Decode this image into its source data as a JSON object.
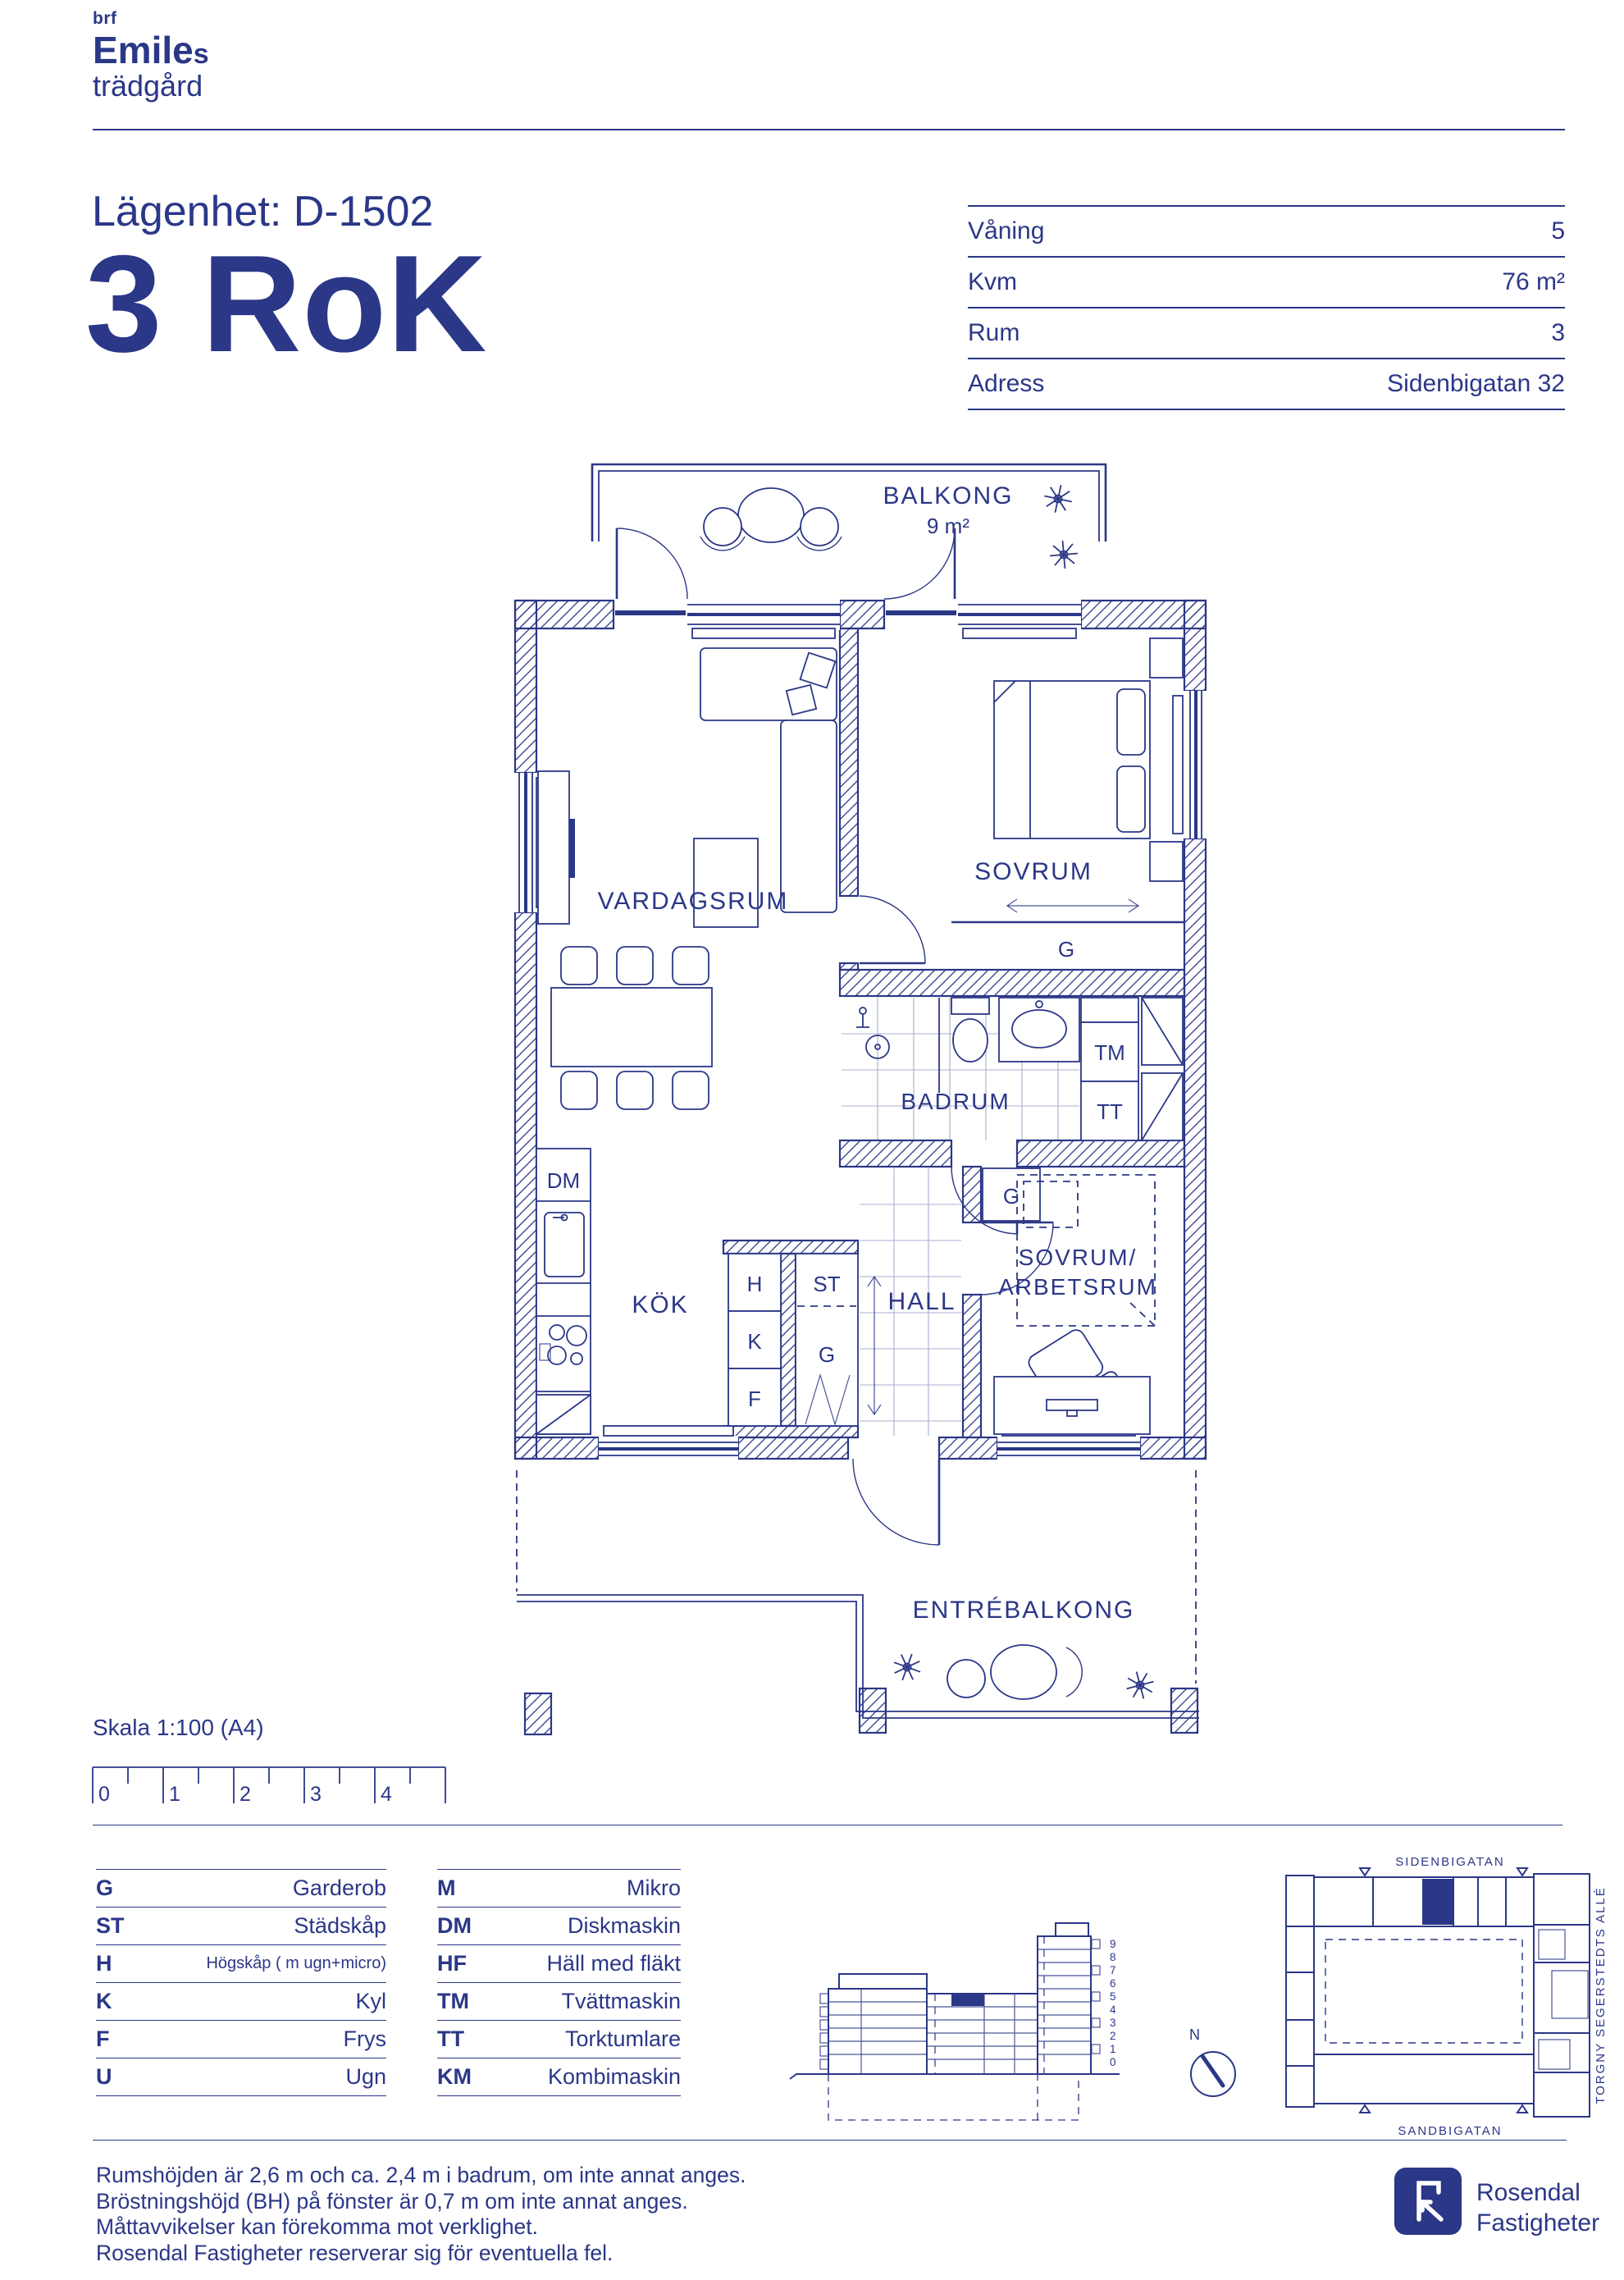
{
  "colors": {
    "navy": "#2b3787",
    "background": "#ffffff"
  },
  "brand": {
    "small": "brf",
    "name": "Emile",
    "name_suffix": "s",
    "sub": "trädgård"
  },
  "header": {
    "apartment": "Lägenhet: D-1502",
    "rok": "3 RoK"
  },
  "info": {
    "rows": [
      {
        "label": "Våning",
        "value": "5"
      },
      {
        "label": "Kvm",
        "value": "76 m²"
      },
      {
        "label": "Rum",
        "value": "3"
      },
      {
        "label": "Adress",
        "value": "Sidenbigatan 32"
      }
    ]
  },
  "plan": {
    "balcony": "BALKONG",
    "balcony_area": "9 m²",
    "living": "VARDAGSRUM",
    "bedroom": "SOVRUM",
    "bathroom": "BADRUM",
    "kitchen": "KÖK",
    "hall": "HALL",
    "bedroom2a": "SOVRUM/",
    "bedroom2b": "ARBETSRUM",
    "entry_balcony": "ENTRÉBALKONG",
    "g": "G",
    "tm": "TM",
    "tt": "TT",
    "h": "H",
    "k": "K",
    "f": "F",
    "st": "ST",
    "dm": "DM"
  },
  "scalebar": {
    "label": "Skala 1:100 (A4)",
    "ticks": [
      "0",
      "1",
      "2",
      "3",
      "4"
    ]
  },
  "legend": {
    "col1": [
      {
        "abbr": "G",
        "label": "Garderob"
      },
      {
        "abbr": "ST",
        "label": "Städskåp"
      },
      {
        "abbr": "H",
        "label": "Högskåp ( m ugn+micro)"
      },
      {
        "abbr": "K",
        "label": "Kyl"
      },
      {
        "abbr": "F",
        "label": "Frys"
      },
      {
        "abbr": "U",
        "label": "Ugn"
      }
    ],
    "col2": [
      {
        "abbr": "M",
        "label": "Mikro"
      },
      {
        "abbr": "DM",
        "label": "Diskmaskin"
      },
      {
        "abbr": "HF",
        "label": "Häll med fläkt"
      },
      {
        "abbr": "TM",
        "label": "Tvättmaskin"
      },
      {
        "abbr": "TT",
        "label": "Torktumlare"
      },
      {
        "abbr": "KM",
        "label": "Kombimaskin"
      }
    ]
  },
  "elevation": {
    "floors": [
      "9",
      "8",
      "7",
      "6",
      "5",
      "4",
      "3",
      "2",
      "1",
      "0"
    ]
  },
  "site": {
    "street_top": "SIDENBIGATAN",
    "street_bottom": "SANDBIGATAN",
    "street_right": "TORGNY SEGERSTEDTS ALLÉ",
    "north": "N"
  },
  "footer": {
    "lines": [
      "Rumshöjden är 2,6 m och ca. 2,4 m i badrum, om inte annat anges.",
      "Bröstningshöjd (BH) på fönster är 0,7 m om inte annat anges.",
      "Måttavvikelser kan förekomma mot verklighet.",
      "Rosendal Fastigheter reserverar sig för eventuella fel."
    ]
  },
  "company": {
    "line1": "Rosendal",
    "line2": "Fastigheter"
  }
}
